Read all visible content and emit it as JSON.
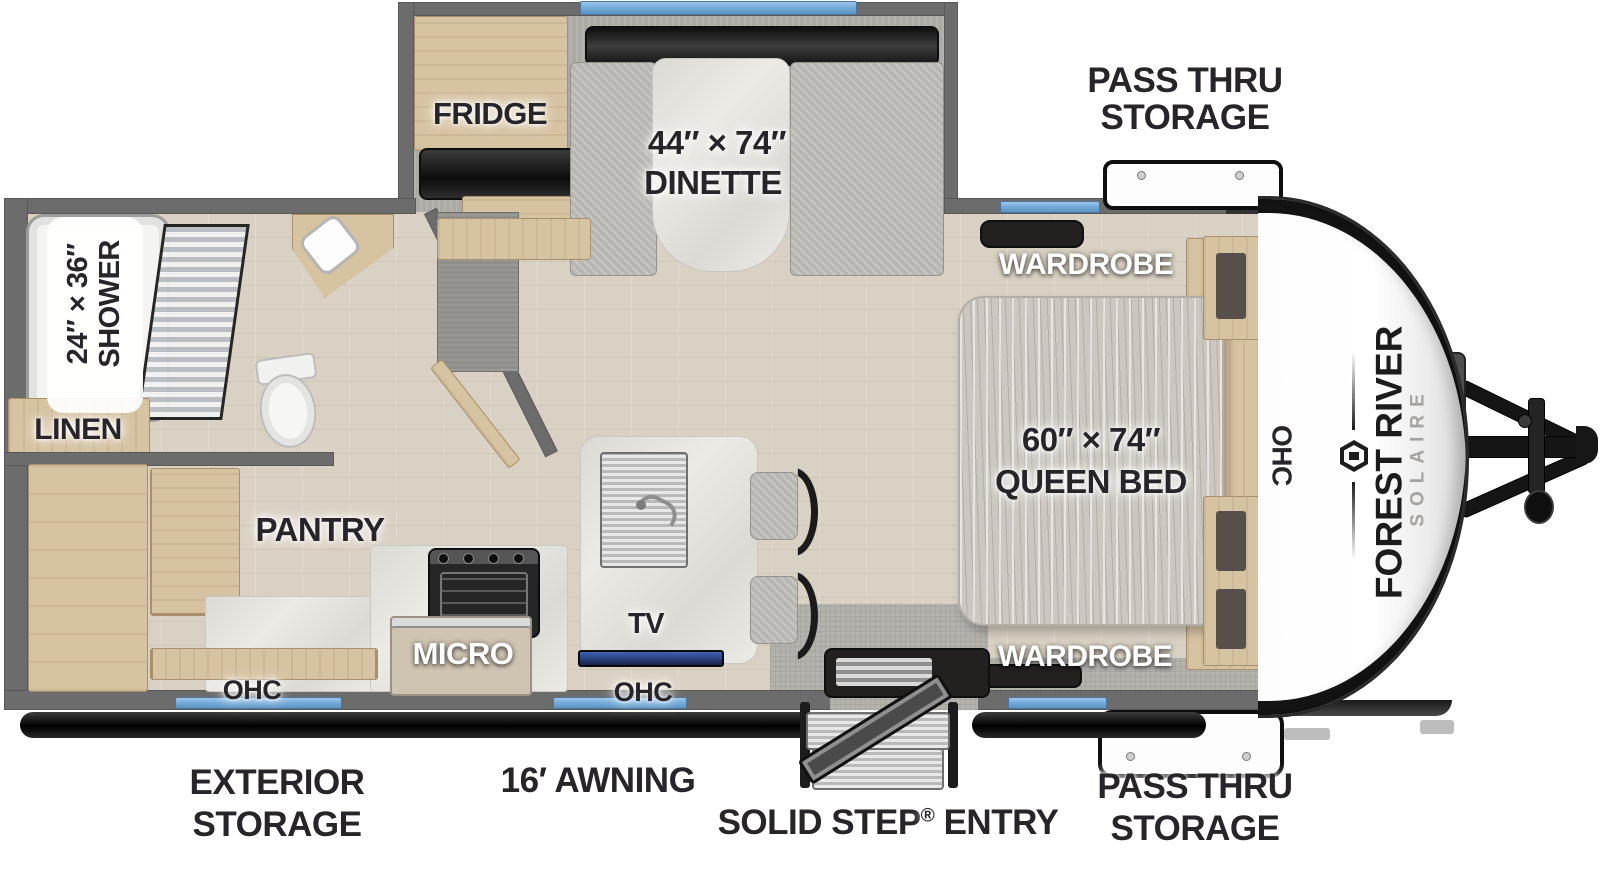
{
  "brand": {
    "make": "FOREST RIVER",
    "model": "SOLAIRE"
  },
  "slide_out": {
    "fridge": "FRIDGE",
    "dinette_size": "44″ × 74″",
    "dinette": "DINETTE"
  },
  "bedroom": {
    "wardrobe_top": "WARDROBE",
    "wardrobe_bottom": "WARDROBE",
    "bed_size": "60″ × 74″",
    "bed": "QUEEN BED",
    "ohc": "OHC"
  },
  "bathroom": {
    "shower_size": "24″ × 36″",
    "shower": "SHOWER",
    "linen": "LINEN"
  },
  "kitchen": {
    "pantry": "PANTRY",
    "micro": "MICRO",
    "tv": "TV",
    "ohc_left": "OHC",
    "ohc_right": "OHC"
  },
  "exterior": {
    "pass_thru_top": [
      "PASS THRU",
      "STORAGE"
    ],
    "pass_thru_bottom": [
      "PASS THRU",
      "STORAGE"
    ],
    "exterior_storage": [
      "EXTERIOR",
      "STORAGE"
    ],
    "awning": "16′ AWNING",
    "solid_step": {
      "name": "SOLID STEP",
      "reg": "®",
      "suffix": " ENTRY"
    }
  },
  "colors": {
    "wall": "#6c6c6c",
    "window_blue": "#74aad9",
    "awning_black": "#111111",
    "cabinet_wood": "#d6c3a2",
    "counter_white": "#eceae5",
    "floor_wood": "#d9d1c3",
    "slide_carpet": "#abaaa5",
    "label_dark": "#272529",
    "label_light": "#ffffff",
    "tv_blue": "#2b4d9e"
  }
}
